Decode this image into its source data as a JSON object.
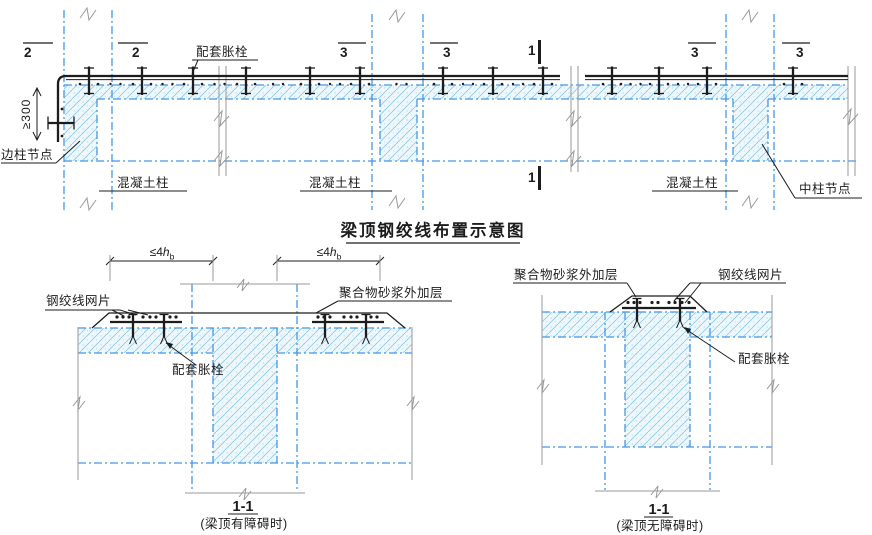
{
  "colors": {
    "line_black": "#1c1c1c",
    "blue_dash": "#4498e8",
    "hatch_blue": "#8fcbe8",
    "hatch_dot": "#b8e0f2",
    "hatch_bg": "#eef7fc",
    "gray_line": "#999999"
  },
  "title": "梁顶钢绞线布置示意图",
  "top": {
    "marks": {
      "m2a": "2",
      "m2b": "2",
      "m3a": "3",
      "m3b": "3",
      "m1t": "1",
      "m3c": "3",
      "m3d": "3",
      "m1b": "1"
    },
    "bolt_label": "配套胀栓",
    "edge_joint": "边柱节点",
    "col1": "混凝土柱",
    "col2": "混凝土柱",
    "col3": "混凝土柱",
    "mid_joint": "中柱节点",
    "dim300": "≥300"
  },
  "sec_obstructed": {
    "dim": {
      "lt": "≤4",
      "v": "h",
      "sub": "b"
    },
    "mesh": "钢绞线网片",
    "bolt": "配套胀栓",
    "mortar": "聚合物砂浆外加层",
    "num": "1-1",
    "note": "(梁顶有障碍时)"
  },
  "sec_clear": {
    "mortar": "聚合物砂浆外加层",
    "mesh": "钢绞线网片",
    "bolt": "配套胀栓",
    "num": "1-1",
    "note": "(梁顶无障碍时)"
  }
}
